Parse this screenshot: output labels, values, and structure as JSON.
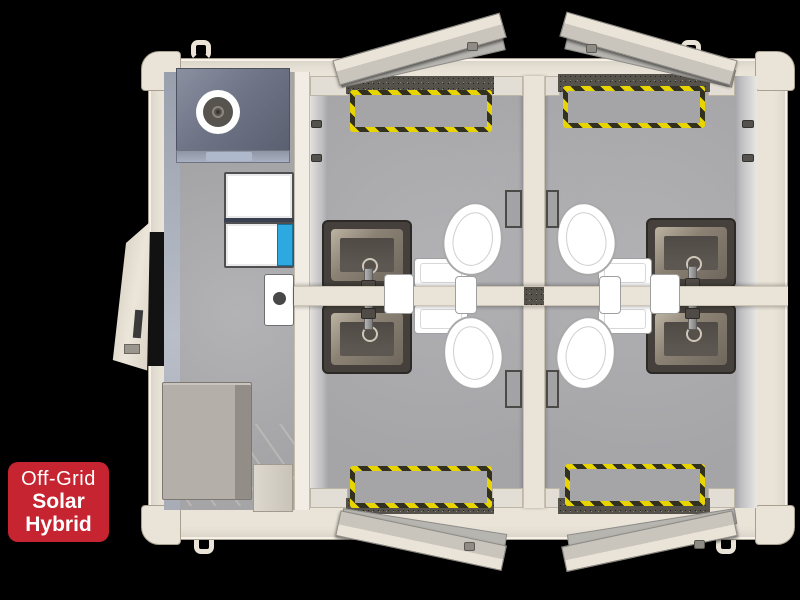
{
  "badge": {
    "line1": "Off-Grid",
    "line2": "Solar",
    "line3": "Hybrid"
  },
  "colors": {
    "background": "#000000",
    "badge_red": "#C62430",
    "badge_text": "#FFFFFF",
    "frame_cream": "#EAE4D8",
    "frame_edge": "#A89F8E",
    "wall_white": "#F1EDE4",
    "floor_gray": "#A5A5A8",
    "slate": "#6F7587",
    "slate_dark": "#5A6070",
    "vent_blue": "#AEB9CC",
    "equip_blue": "#2EA9E0",
    "hazard_yellow": "#E8D500",
    "hazard_dark": "#32301F",
    "sink_dark": "#45403B",
    "sink_bevel": "#8B8274",
    "sink_basin": "#5D5751",
    "toilet_white": "#FFFFFF",
    "step_dark": "#55514B",
    "door_face": "#C9C5BD",
    "line_gray": "#8E8B85"
  }
}
